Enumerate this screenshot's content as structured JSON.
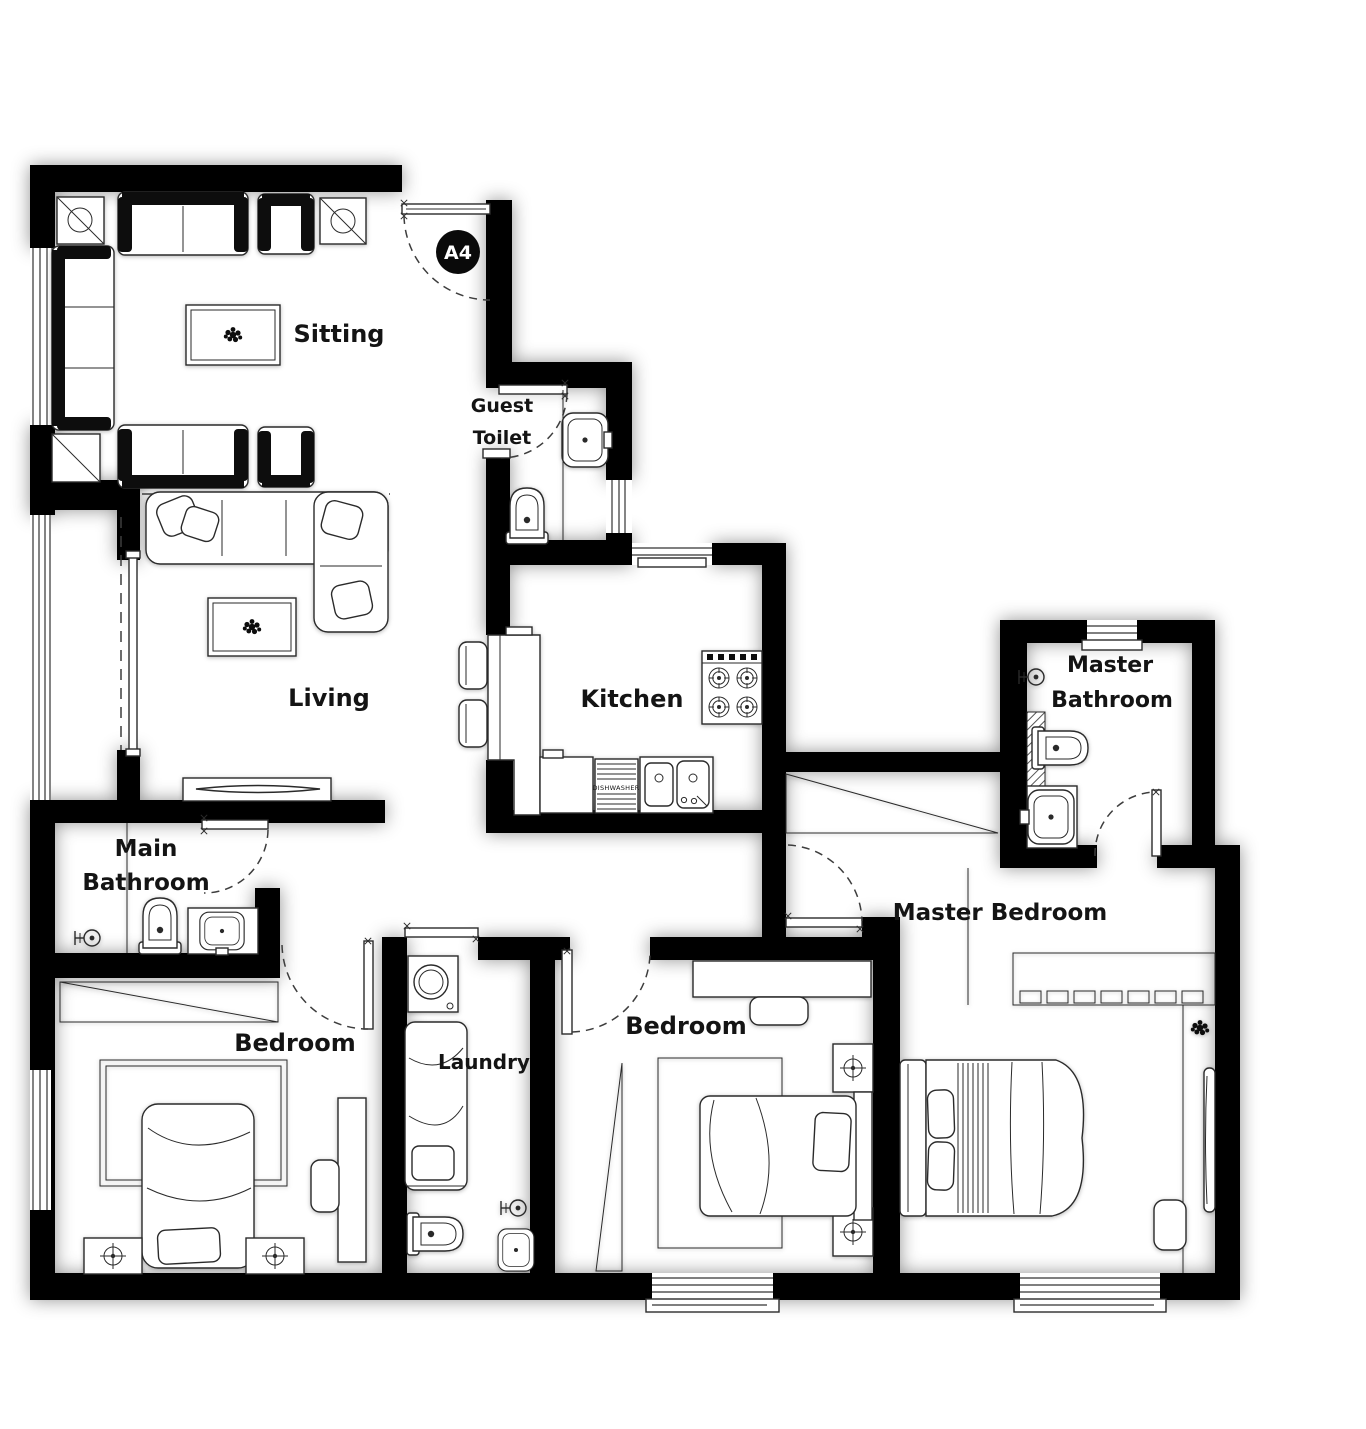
{
  "plan": {
    "unit_badge": "A4",
    "rooms": {
      "sitting": {
        "label": "Sitting"
      },
      "guest_toilet": {
        "line1": "Guest",
        "line2": "Toilet"
      },
      "kitchen": {
        "label": "Kitchen"
      },
      "living": {
        "label": "Living"
      },
      "main_bathroom": {
        "line1": "Main",
        "line2": "Bathroom"
      },
      "master_bathroom": {
        "line1": "Master",
        "line2": "Bathroom"
      },
      "master_bedroom": {
        "label": "Master Bedroom"
      },
      "bedroom_left": {
        "label": "Bedroom"
      },
      "bedroom_middle": {
        "label": "Bedroom"
      },
      "laundry": {
        "label": "Laundry"
      }
    },
    "appliance_labels": {
      "dishwasher": "DISHWASHER"
    },
    "colors": {
      "wall": "#060606",
      "background": "#ffffff",
      "furniture_line": "#2b2b2b",
      "text": "#141414",
      "badge_background": "#0a0a0a",
      "badge_text": "#ffffff"
    }
  }
}
